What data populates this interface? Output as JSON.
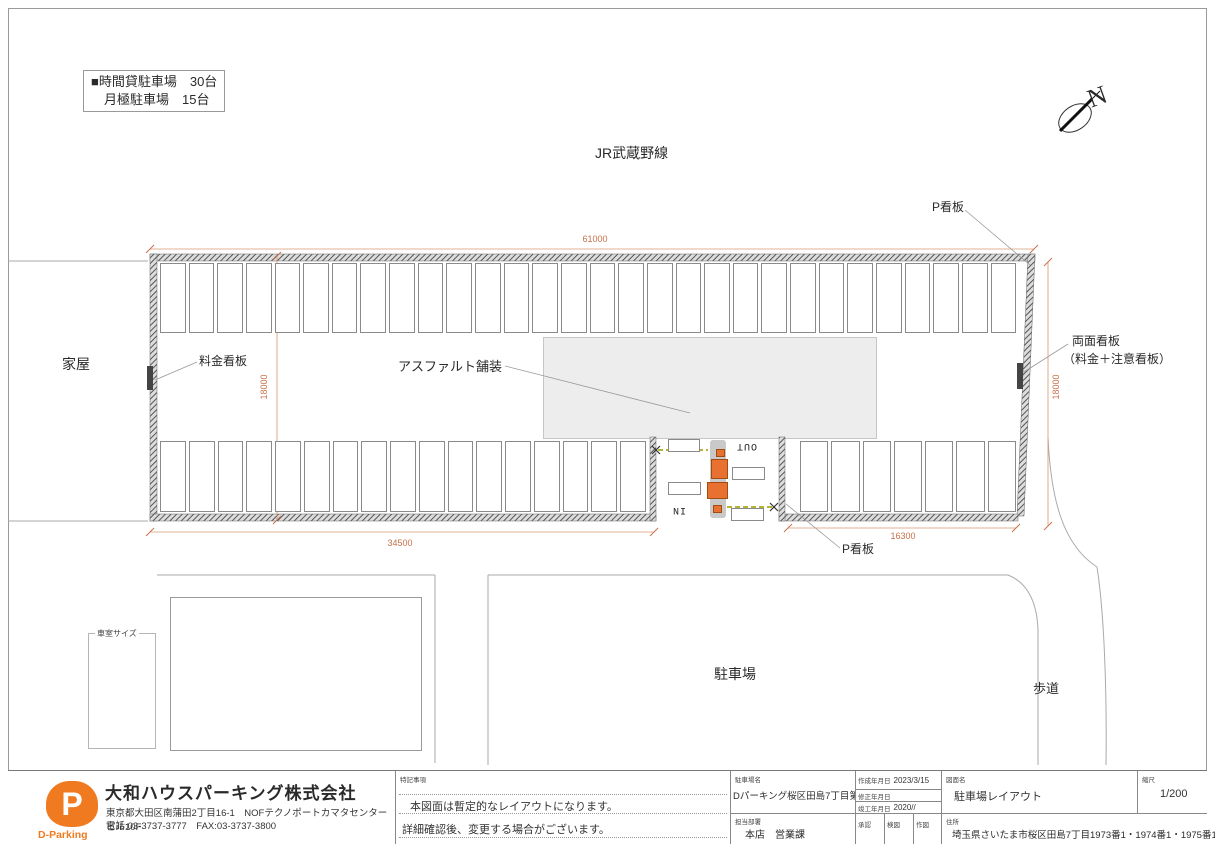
{
  "colors": {
    "accent_orange": "#f07a20",
    "dimension": "#c8714a"
  },
  "legend": {
    "line1": "■時間貸駐車場　30台",
    "line2": "月極駐車場　15台"
  },
  "labels": {
    "railway": "JR武蔵野線",
    "north": "N",
    "p_sign_top": "P看板",
    "p_sign_bottom": "P看板",
    "fee_sign": "料金看板",
    "asphalt": "アスファルト舗装",
    "double_sign_line1": "両面看板",
    "double_sign_line2": "（料金＋注意看板）",
    "house_left": "家屋",
    "house_bottom": "家屋",
    "parking_area": "駐車場",
    "sidewalk": "歩道",
    "stall_size": "車室サイズ",
    "lane_in": "IN",
    "lane_out": "OUT"
  },
  "dimensions": {
    "top": "61000",
    "left": "18000",
    "right": "18000",
    "bottom_left": "34500",
    "bottom_right": "16300",
    "stall_depth": "5000",
    "stall_width": "2400"
  },
  "lot": {
    "top_stalls": 30,
    "bottom_left_stalls": 17,
    "bottom_right_stalls": 7
  },
  "title_block": {
    "company": {
      "name": "大和ハウスパーキング株式会社",
      "address": "東京都大田区南蒲田2丁目16-1　NOFテクノポートカマタセンタービル10F",
      "tel": "電話:03-3737-3777　FAX:03-3737-3800",
      "logo_letter": "P",
      "logo_text": "D-Parking"
    },
    "notes": {
      "header": "特記事項",
      "line1": "本図面は暫定的なレイアウトになります。",
      "line2": "詳細確認後、変更する場合がございます。"
    },
    "site": {
      "name_label": "駐車場名",
      "name": "Dパーキング桜区田島7丁目第1",
      "dept_label": "担当部署",
      "dept": "本店　営業課"
    },
    "dates": {
      "created_label": "作成年月日",
      "created": "2023/3/15",
      "revised_label": "修正年月日",
      "revised": "",
      "completed_label": "竣工年月日",
      "completed": "2020//"
    },
    "approval_cells": [
      "承認",
      "検図",
      "作図"
    ],
    "drawing": {
      "name_label": "図面名",
      "name": "駐車場レイアウト",
      "scale_label": "縮尺",
      "scale": "1/200",
      "address_label": "住所",
      "address": "埼玉県さいたま市桜区田島7丁目1973番1・1974番1・1975番1"
    }
  }
}
